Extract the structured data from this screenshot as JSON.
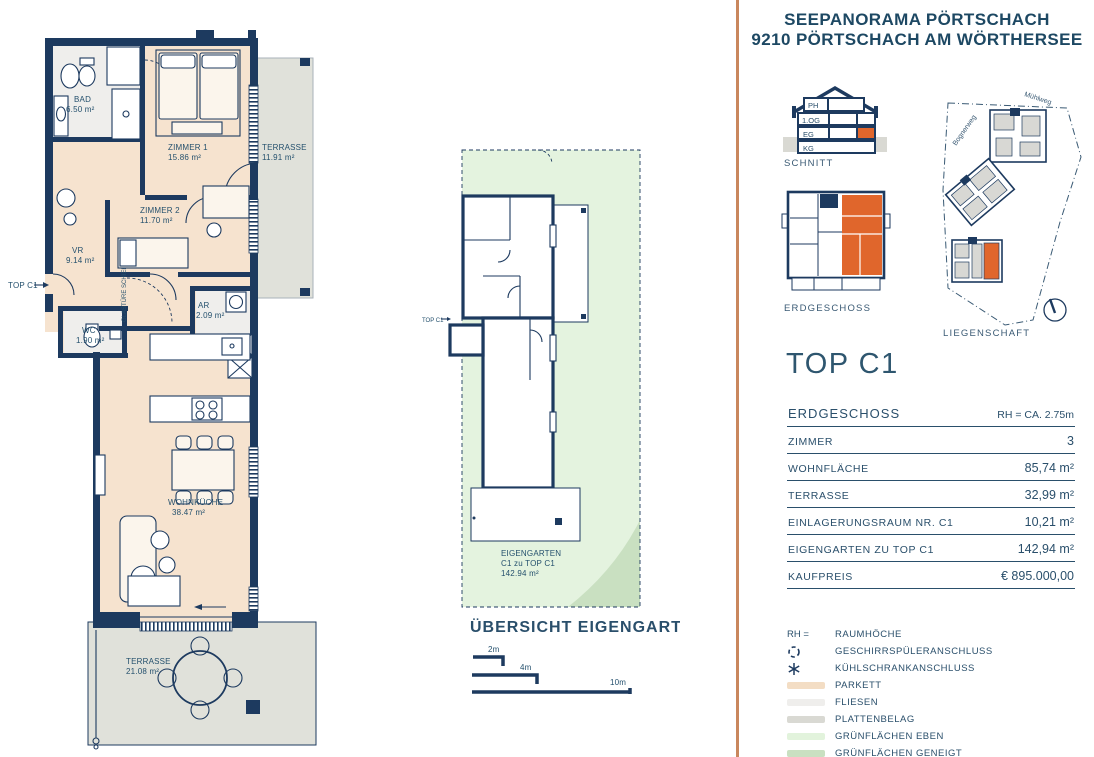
{
  "header": {
    "line1": "SEEPANORAMA PÖRTSCHACH",
    "line2": "9210 PÖRTSCHACH AM WÖRTHERSEE"
  },
  "colors": {
    "navy": "#1d3a5f",
    "text_navy": "#2a4f6b",
    "orange": "#e0662c",
    "divider": "#c9875d",
    "parkett": "#f6e3cf",
    "fliesen": "#efeeec",
    "plattenbelag": "#e0e1da",
    "gruen_eben": "#e4f3df",
    "gruen_geneigt": "#c9e0c1"
  },
  "floorplan": {
    "entrance_label": "TOP C1",
    "door_note": "GLASTÜRE SCHIEBETÜRE",
    "rooms": [
      {
        "name": "BAD",
        "area": "6.50 m²"
      },
      {
        "name": "ZIMMER 1",
        "area": "15.86 m²"
      },
      {
        "name": "TERRASSE",
        "area": "11.91 m²"
      },
      {
        "name": "ZIMMER 2",
        "area": "11.70 m²"
      },
      {
        "name": "VR",
        "area": "9.14 m²"
      },
      {
        "name": "WC",
        "area": "1.90 m²"
      },
      {
        "name": "AR",
        "area": "2.09 m²"
      },
      {
        "name": "WOHNKÜCHE",
        "area": "38.47 m²"
      },
      {
        "name": "TERRASSE",
        "area": "21.08 m²"
      }
    ]
  },
  "garden_overview": {
    "title": "ÜBERSICHT EIGENGARTEN",
    "entrance_label": "TOP C1",
    "garden_line1": "EIGENGARTEN",
    "garden_line2": "C1 zu TOP C1",
    "garden_line3": "142.94 m²",
    "scale": {
      "s2": "2m",
      "s4": "4m",
      "s10": "10m"
    }
  },
  "sidebar": {
    "schnitt": {
      "label": "SCHNITT",
      "floors": [
        "PH",
        "1.OG",
        "EG",
        "KG"
      ]
    },
    "erdgeschoss_label": "ERDGESCHOSS",
    "liegenschaft": {
      "label": "LIEGENSCHAFT",
      "street1": "Bognerweg",
      "street2": "Mühlweg"
    },
    "unit_title": "TOP C1",
    "table": [
      {
        "label": "ERDGESCHOSS",
        "value": "RH = CA. 2.75m"
      },
      {
        "label": "ZIMMER",
        "value": "3"
      },
      {
        "label": "WOHNFLÄCHE",
        "value": "85,74 m²"
      },
      {
        "label": "TERRASSE",
        "value": "32,99 m²"
      },
      {
        "label": "EINLAGERUNGSRAUM NR. C1",
        "value": "10,21 m²"
      },
      {
        "label": "EIGENGARTEN ZU TOP C1",
        "value": "142,94 m²"
      },
      {
        "label": "KAUFPREIS",
        "value": "€ 895.000,00"
      }
    ],
    "legend": {
      "rh_key": "RH =",
      "items": [
        {
          "label": "RAUMHÖCHE"
        },
        {
          "label": "GESCHIRRSPÜLERANSCHLUSS"
        },
        {
          "label": "KÜHLSCHRANKANSCHLUSS"
        },
        {
          "label": "PARKETT",
          "color": "#f3ddc4"
        },
        {
          "label": "FLIESEN",
          "color": "#efeeec"
        },
        {
          "label": "PLATTENBELAG",
          "color": "#d9d9d3"
        },
        {
          "label": "GRÜNFLÄCHEN EBEN",
          "color": "#e2f3dc"
        },
        {
          "label": "GRÜNFLÄCHEN GENEIGT",
          "color": "#c9e0c1"
        }
      ]
    }
  }
}
